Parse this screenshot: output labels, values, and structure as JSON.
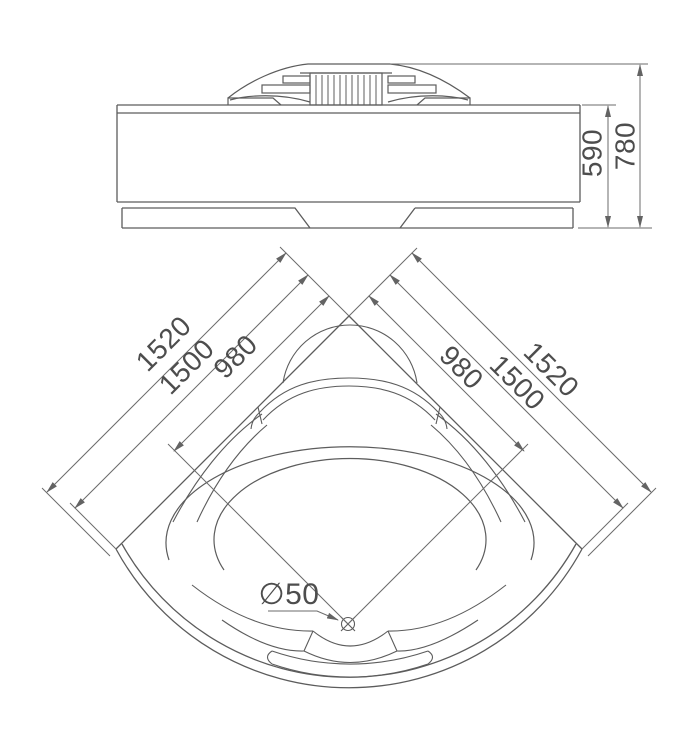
{
  "side_view": {
    "dim_inner_height": "590",
    "dim_total_height": "780"
  },
  "plan_view": {
    "dim_left_overall": "1520",
    "dim_left_edge": "1500",
    "dim_left_basin": "980",
    "dim_right_basin": "980",
    "dim_right_edge": "1500",
    "dim_right_overall": "1520",
    "drain_diameter": "∅50"
  },
  "colors": {
    "line": "#5c5c5c",
    "dim_line": "#6b6b6b",
    "text": "#4d4d4d",
    "background": "#ffffff"
  }
}
